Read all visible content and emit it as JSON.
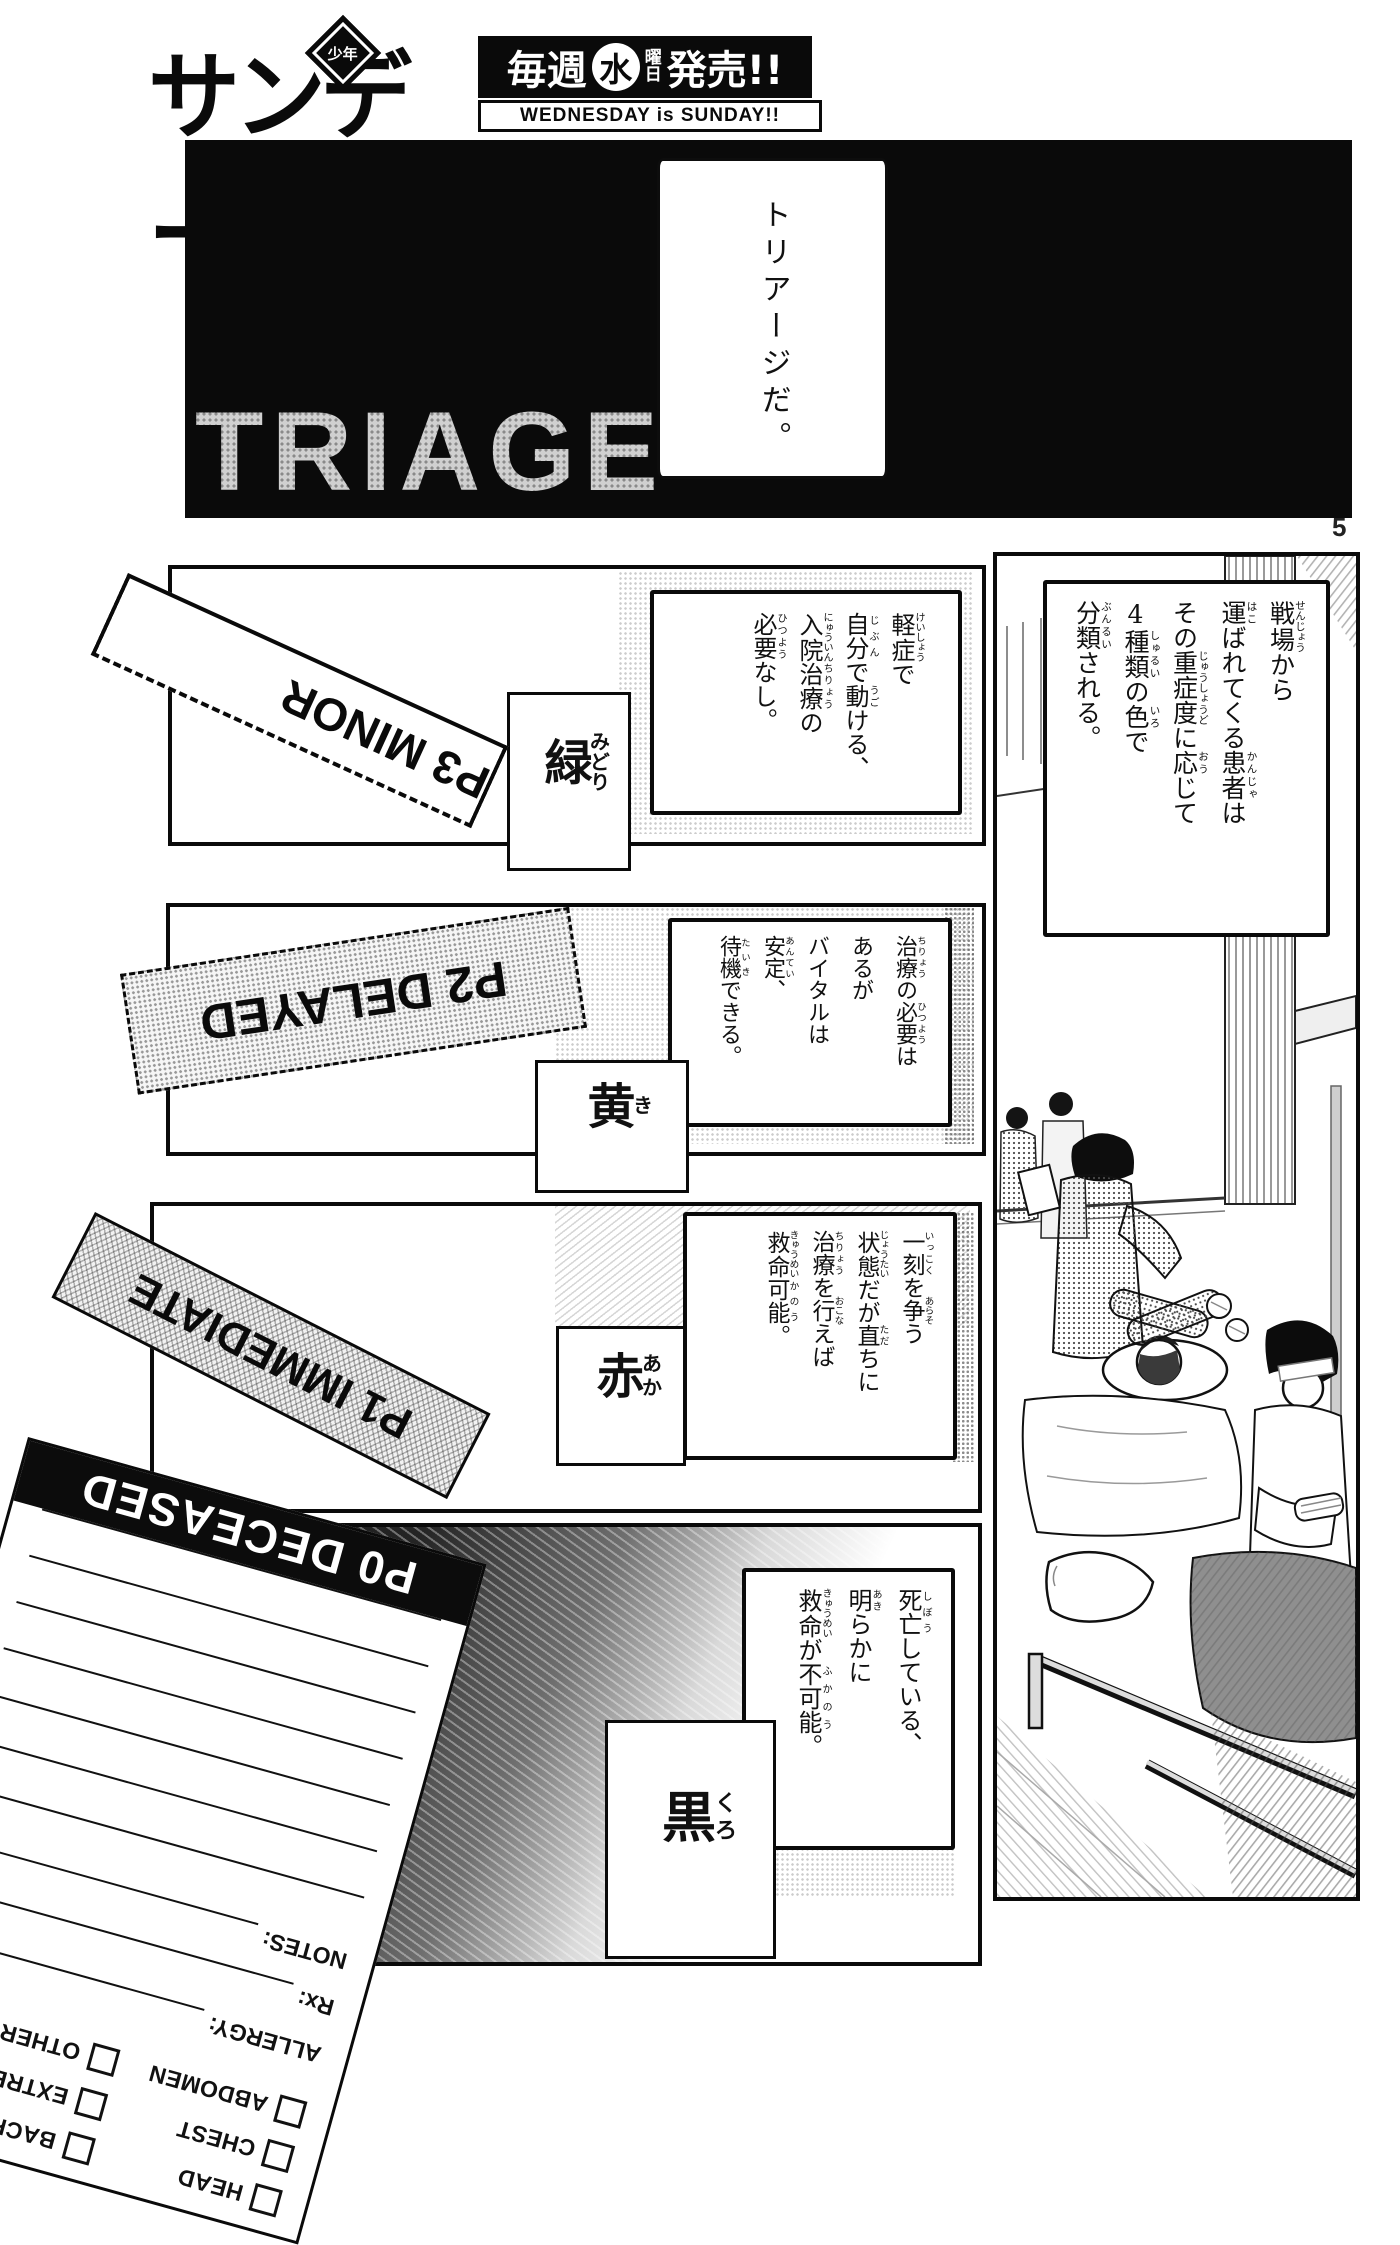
{
  "colors": {
    "ink": "#111111",
    "paper": "#ffffff",
    "tone_gray": "#b5b5b5"
  },
  "header": {
    "logo_text": "サンデー",
    "logo_badge": "少年",
    "schedule_pre": "毎週",
    "schedule_day": "水",
    "schedule_day_unit1": "曜",
    "schedule_day_unit2": "日",
    "schedule_post": "発売!!",
    "tagline": "WEDNESDAY is SUNDAY!!"
  },
  "page_number": "5",
  "title_panel": {
    "title": "TRIAGE",
    "speech": "トリアージだ。"
  },
  "intro": {
    "cols": [
      [
        {
          "b": "戦場",
          "r": "せんじょう"
        },
        "から"
      ],
      [
        {
          "b": "運",
          "r": "はこ"
        },
        "ばれてくる",
        {
          "b": "患者",
          "r": "かんじゃ"
        },
        "は"
      ],
      [
        "その",
        {
          "b": "重症度",
          "r": "じゅうしょうど"
        },
        "に",
        {
          "b": "応",
          "r": "おう"
        },
        "じて"
      ],
      [
        {
          "u": "4"
        },
        {
          "b": "種類",
          "r": "しゅるい"
        },
        "の",
        {
          "b": "色",
          "r": "いろ"
        },
        "で"
      ],
      [
        {
          "b": "分類",
          "r": "ぶんるい"
        },
        "される。"
      ]
    ]
  },
  "sections": {
    "green": {
      "tag": "P3 MINOR",
      "label": [
        {
          "b": "緑",
          "r": "みどり"
        }
      ],
      "desc": [
        [
          {
            "b": "軽症",
            "r": "けいしょう"
          },
          "で"
        ],
        [
          {
            "b": "自分",
            "r": "じぶん"
          },
          "で",
          {
            "b": "動",
            "r": "うご"
          },
          "ける、"
        ],
        [
          {
            "b": "入院",
            "r": "にゅういん"
          },
          {
            "b": "治療",
            "r": "ちりょう"
          },
          "の"
        ],
        [
          {
            "b": "必要",
            "r": "ひつよう"
          },
          "なし。"
        ]
      ]
    },
    "yellow": {
      "tag": "P2 DELAYED",
      "label": [
        {
          "b": "黄",
          "r": "き"
        }
      ],
      "desc": [
        [
          {
            "b": "治療",
            "r": "ちりょう"
          },
          "の",
          {
            "b": "必要",
            "r": "ひつよう"
          },
          "は"
        ],
        [
          "あるが"
        ],
        [
          "バイタルは",
          {
            "b": "安定",
            "r": "あんてい"
          },
          "、"
        ],
        [
          {
            "b": "待機",
            "r": "たいき"
          },
          "できる。"
        ]
      ]
    },
    "red": {
      "tag": "P1 IMMEDIATE",
      "label": [
        {
          "b": "赤",
          "r": "あか"
        }
      ],
      "desc": [
        [
          {
            "b": "一刻",
            "r": "いっこく"
          },
          "を",
          {
            "b": "争",
            "r": "あらそ"
          },
          "う"
        ],
        [
          {
            "b": "状態",
            "r": "じょうたい"
          },
          "だが",
          {
            "b": "直",
            "r": "ただ"
          },
          "ちに"
        ],
        [
          {
            "b": "治療",
            "r": "ちりょう"
          },
          "を",
          {
            "b": "行",
            "r": "おこな"
          },
          "えば"
        ],
        [
          {
            "b": "救命",
            "r": "きゅうめい"
          },
          {
            "b": "可能",
            "r": "かのう"
          },
          "。"
        ]
      ]
    },
    "black": {
      "label": [
        {
          "b": "黒",
          "r": "くろ"
        }
      ],
      "desc": [
        [
          {
            "b": "死亡",
            "r": "しぼう"
          },
          "している、"
        ],
        [
          {
            "b": "明",
            "r": "あき"
          },
          "らかに"
        ],
        [
          {
            "b": "救命",
            "r": "きゅうめい"
          },
          "が",
          {
            "b": "不可能",
            "r": "ふかのう"
          },
          "。"
        ]
      ]
    }
  },
  "form": {
    "title": "P0 DECEASED",
    "checkbox_col1": [
      "HEAD",
      "CHEST",
      "ABDOMEN"
    ],
    "checkbox_col2": [
      "BACK",
      "EXTREMITES",
      "OTHER"
    ],
    "fields": [
      "ALLERGY:",
      "Rx:",
      "NOTES:"
    ]
  }
}
